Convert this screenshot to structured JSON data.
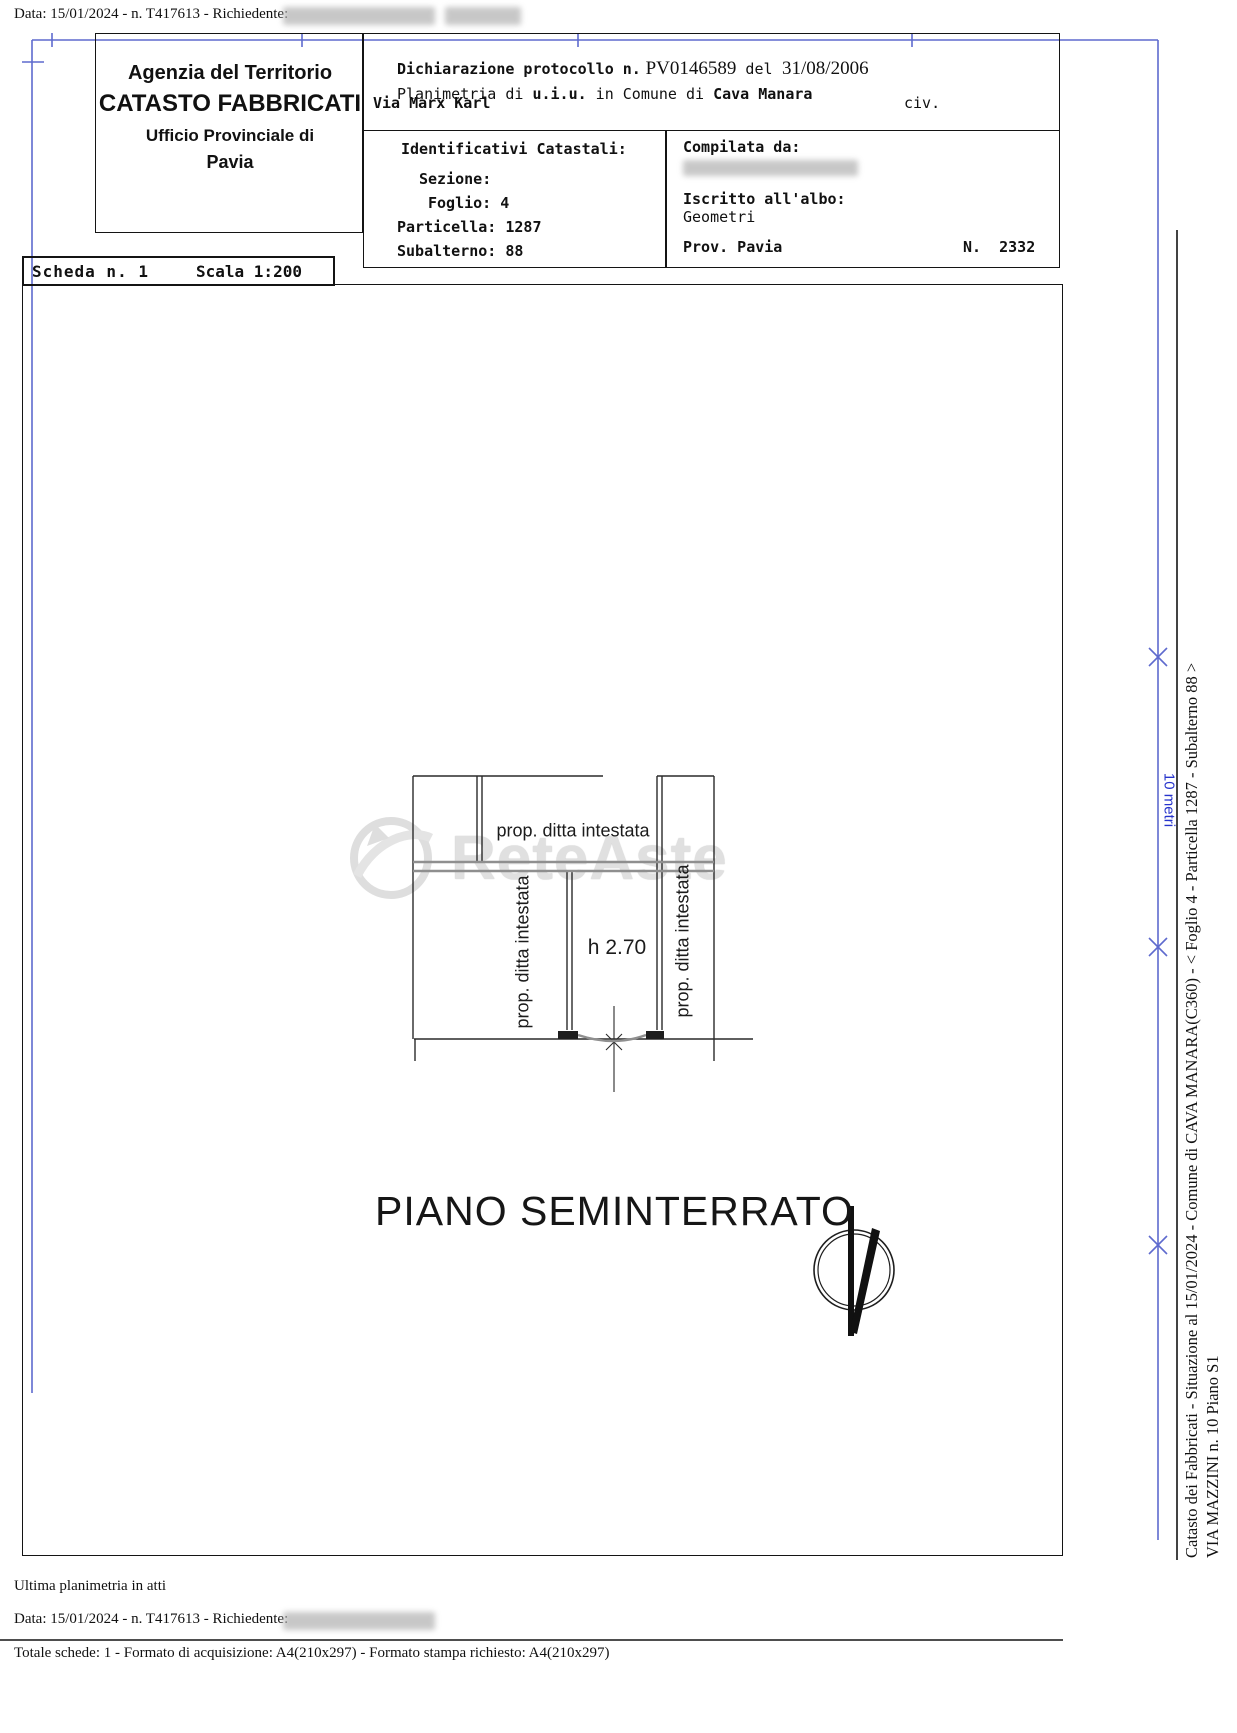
{
  "page": {
    "top_line": "Data: 15/01/2024 - n. T417613 - Richiedente:"
  },
  "header_left": {
    "line1": "Agenzia del Territorio",
    "line2": "CATASTO FABBRICATI",
    "line3": "Ufficio Provinciale di",
    "line4": "Pavia"
  },
  "declaration": {
    "label": "Dichiarazione protocollo n.",
    "protocol": "PV0146589",
    "del": "del",
    "date": "31/08/2006",
    "planimetria_p1": "Planimetria di ",
    "planimetria_p2": "u.i.u.",
    "planimetria_p3": " in Comune di ",
    "planimetria_p4": "Cava Manara",
    "street": "Via Marx Karl",
    "civ": "civ."
  },
  "identificativi": {
    "title": "Identificativi Catastali:",
    "sezione": "Sezione:",
    "foglio": "Foglio: 4",
    "particella": "Particella: 1287",
    "subalterno": "Subalterno: 88"
  },
  "compilata": {
    "label": "Compilata da:",
    "albo_label": "Iscritto all'albo:",
    "albo_value": "Geometri",
    "prov": "Prov. Pavia",
    "number": "N.  2332"
  },
  "scheda": {
    "scheda": "Scheda n. 1",
    "scala": "Scala 1:200"
  },
  "plan": {
    "room_label_top": "prop. ditta intestata",
    "room_label_left": "prop. ditta intestata",
    "room_label_right": "prop. ditta intestata",
    "height_label": "h 2.70",
    "floor_title": "PIANO SEMINTERRATO"
  },
  "watermark": {
    "text": "ReteAste"
  },
  "scale_bar": {
    "label": "10 metri"
  },
  "side_captions": {
    "line1": "Catasto dei Fabbricati - Situazione al 15/01/2024 - Comune di CAVA MANARA(C360) - < Foglio 4 - Particella 1287 - Subalterno 88 >",
    "line2": "VIA MAZZINI n. 10 Piano S1"
  },
  "footer": {
    "ultima": "Ultima planimetria in atti",
    "data_line": "Data: 15/01/2024 - n. T417613 - Richiedente:",
    "totale": "Totale schede: 1 - Formato di acquisizione: A4(210x297)  - Formato stampa richiesto: A4(210x297)"
  },
  "colors": {
    "frame_blue": "#5e6ace",
    "scale_blue": "#2633cc",
    "ink": "#141414"
  }
}
